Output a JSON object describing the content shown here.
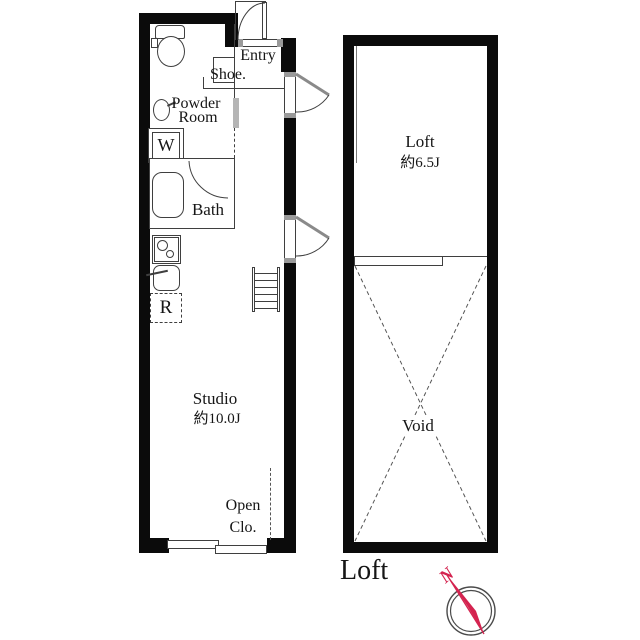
{
  "plan": {
    "left_unit": {
      "entry_label": "Entry",
      "shoe_label": "Shoe.",
      "powder_room_line1": "Powder",
      "powder_room_line2": "Room",
      "washer_label": "W",
      "bath_label": "Bath",
      "refrigerator_label": "R",
      "studio_label": "Studio",
      "studio_size": "約10.0J",
      "open_closet_line1": "Open",
      "open_closet_line2": "Clo."
    },
    "loft_unit": {
      "loft_label": "Loft",
      "loft_size": "約6.5J",
      "void_label": "Void"
    },
    "floor_name": "Loft",
    "compass_north": "N"
  },
  "colors": {
    "wall": "#0b0b0b",
    "line": "#3f3f3f",
    "compass_accent": "#d4234f"
  }
}
